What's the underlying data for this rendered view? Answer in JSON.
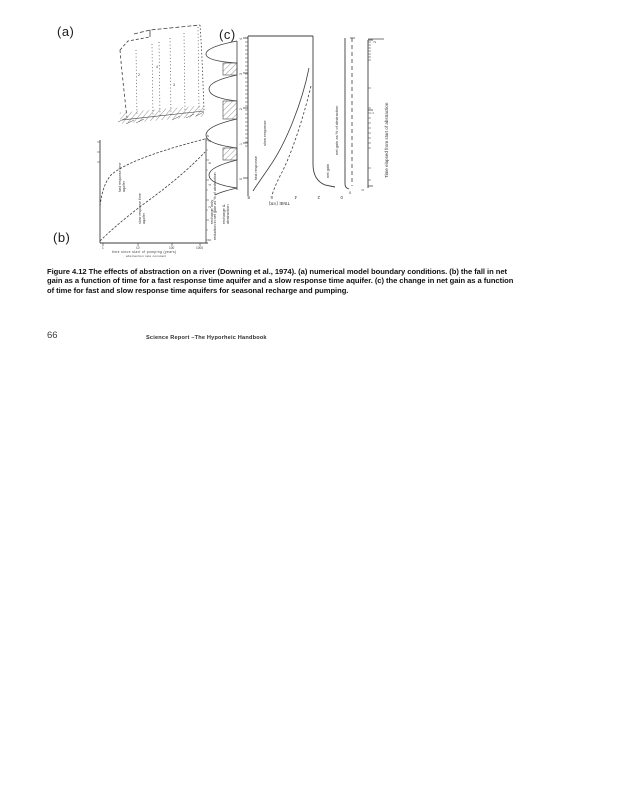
{
  "panels": {
    "a": "(a)",
    "b": "(b)",
    "c": "(c)"
  },
  "caption": {
    "line1": "Figure 4.12 The effects of abstraction on a river (Downing et al., 1974). (a) numerical model boundary conditions. (b) the fall in net",
    "line2": "gain as a function of time for a fast response time aquifer and a slow  response time aquifer. (c) the change in net gain as a function",
    "line3": "of time for fast and slow  response time aquifers for seasonal  recharge and pumping."
  },
  "footer": {
    "page_number": "66",
    "report_title": "Science Report  –The Hyporheic Handbook"
  },
  "fig_a": {
    "marks": [
      "2",
      "4",
      "3"
    ]
  },
  "fig_b": {
    "curve1_line1": "fast response time",
    "curve1_line2": "aquifer",
    "curve2_line1": "slow response time",
    "curve2_line2": "aquifer",
    "right_axis_label": "reduction in net gain as % of abstraction",
    "x_axis_caption": "time since start of pumping (years)",
    "x_axis_caption2": "abstraction rate constant",
    "x_ticks": [
      "1",
      "10",
      "100",
      "1000"
    ],
    "y_ticks": [
      "8",
      "6",
      "4",
      "2",
      "0"
    ],
    "corner_mark": "s"
  },
  "fig_c": {
    "strip_labels": [
      "recharge only",
      "recharge &",
      "abstraction"
    ],
    "left_ticks": [
      "4",
      "3",
      "2",
      "1",
      "0"
    ],
    "x_ticks": [
      "8",
      "6",
      "4",
      "2",
      "0"
    ],
    "x_axis_label": "TIME (YR)",
    "curve_label_slow": "slow response",
    "curve_label_fast": "fast response",
    "mid_axis_label": "net gain as % of abstraction",
    "mid_label_small": "net gain",
    "right_ticks": [
      "2",
      "1",
      "0"
    ],
    "right_axis_label": "Time elapsed from start of abstraction",
    "zero_label": "0"
  }
}
